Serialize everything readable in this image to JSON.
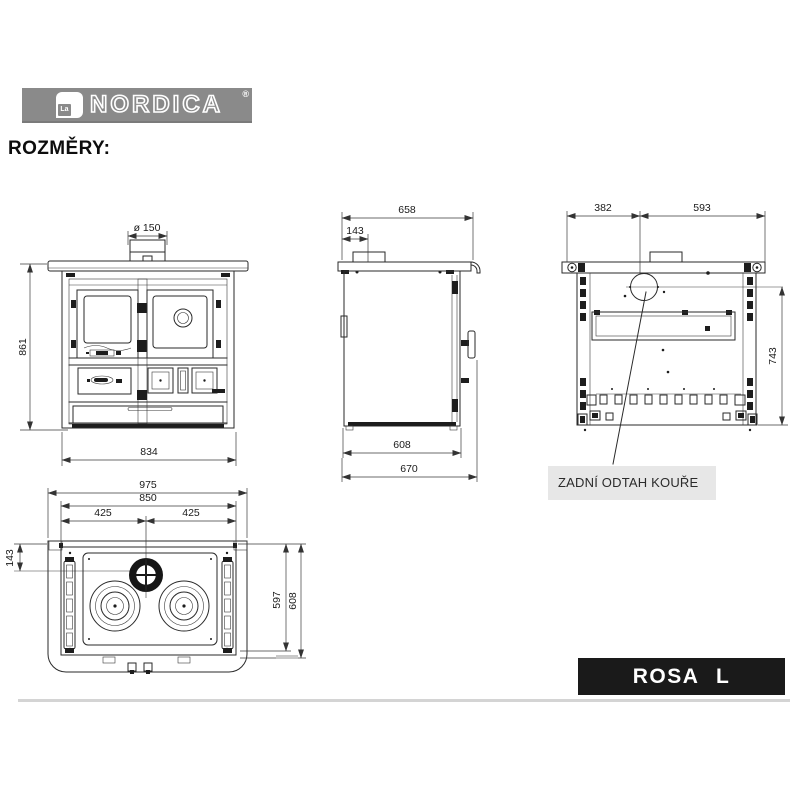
{
  "brand": {
    "mark": "La",
    "name": "NORDICA",
    "registered": "®"
  },
  "heading": "ROZMĚRY:",
  "model_plate": "ROSA L",
  "views": {
    "front": {
      "flue_diameter": "ø 150",
      "height": "861",
      "width": "834"
    },
    "side": {
      "top_depth": "658",
      "flue_offset": "143",
      "body_depth": "608",
      "total_depth": "670"
    },
    "rear": {
      "flue_from_left": "382",
      "flue_to_right": "593",
      "flue_center_height": "743",
      "callout": "ZADNÍ ODTAH KOUŘE"
    },
    "top": {
      "total_width": "975",
      "inner_width": "850",
      "left_half": "425",
      "right_half": "425",
      "flue_offset": "143",
      "plate_depth": "597",
      "total_depth": "608"
    }
  },
  "colors": {
    "logo_band": "#8a8a8a",
    "drawing_line": "#2a2a2a",
    "callout_bg": "#e7e7e7",
    "model_plate_bg": "#1a1a1a",
    "model_plate_text": "#ffffff"
  }
}
